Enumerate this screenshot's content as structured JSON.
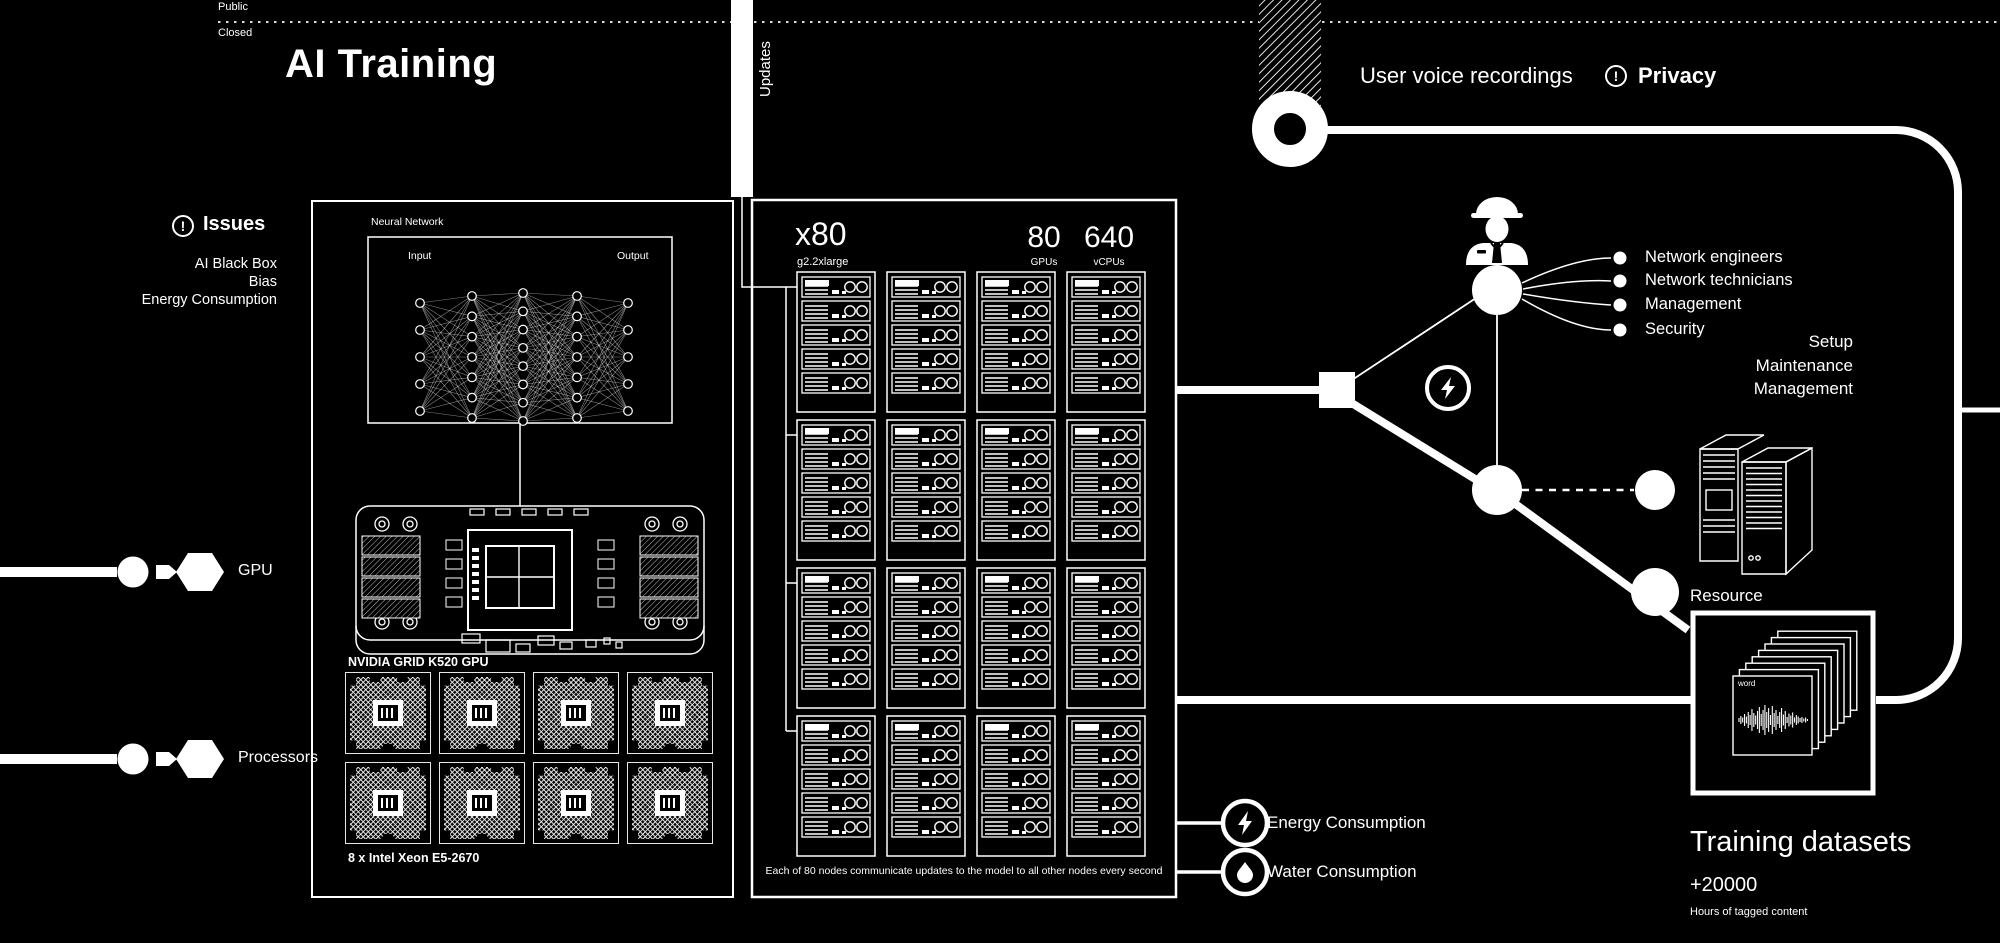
{
  "header": {
    "public_label": "Public",
    "closed_label": "Closed",
    "title": "AI Training",
    "updates_label": "Updates",
    "user_voice_label": "User voice recordings",
    "privacy_label": "Privacy"
  },
  "icons": {
    "alert_glyph": "!",
    "privacy_icon": "info-alert-icon",
    "issues_icon": "info-alert-icon",
    "energy_icon": "lightning-icon",
    "water_icon": "droplet-icon",
    "staff_icon": "engineer-icon",
    "datacenter_icon": "server-cabinet-icon"
  },
  "issues": {
    "title": "Issues",
    "items": [
      "AI Black Box",
      "Bias",
      "Energy Consumption"
    ]
  },
  "model_panel": {
    "neural_network_label": "Neural Network",
    "input_label": "Input",
    "output_label": "Output",
    "gpu_caption": "NVIDIA GRID K520 GPU",
    "cpu_caption": "8 x Intel Xeon E5-2670"
  },
  "hardware_legend": {
    "gpu_label": "GPU",
    "processors_label": "Processors"
  },
  "cluster_panel": {
    "count": "x80",
    "instance_type": "g2.2xlarge",
    "gpus_value": "80",
    "gpus_label": "GPUs",
    "vcpus_value": "640",
    "vcpus_label": "vCPUs",
    "caption": "Each of 80 nodes communicate updates to the model to all other nodes every second"
  },
  "consumption": {
    "energy_label": "Energy Consumption",
    "water_label": "Water Consumption"
  },
  "staff": {
    "roles": [
      "Network engineers",
      "Network technicians",
      "Management",
      "Security"
    ],
    "duties": [
      "Setup",
      "Maintenance",
      "Management"
    ]
  },
  "resource": {
    "label": "Resource"
  },
  "datasets": {
    "card_label": "word",
    "title": "Training datasets",
    "count": "+20000",
    "subtitle": "Hours of tagged content"
  },
  "colors": {
    "background": "#000000",
    "foreground": "#ffffff"
  }
}
